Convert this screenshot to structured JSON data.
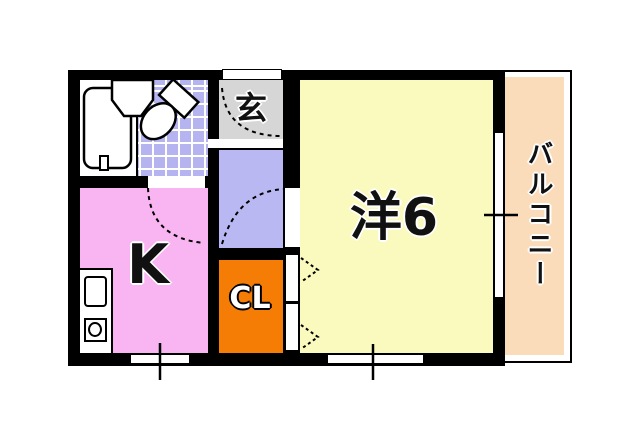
{
  "floorplan": {
    "title": "1K apartment floor plan",
    "rooms": {
      "genkan": {
        "label": "玄"
      },
      "kitchen": {
        "label": "K"
      },
      "closet": {
        "label": "CL"
      },
      "western_room": {
        "label": "洋6"
      },
      "balcony": {
        "label": "バルコニー"
      }
    },
    "colors": {
      "wall": "#000000",
      "background": "#ffffff",
      "tile": "#b5b4f0",
      "hallway": "#b9b8f2",
      "genkan": "#d6d6d6",
      "kitchen": "#f9b5f2",
      "closet": "#f57d05",
      "western_room": "#fafabe",
      "balcony": "#fbdcba"
    },
    "fixtures": [
      "bathtub",
      "washbasin",
      "toilet",
      "kitchen-counter",
      "kitchen-sink",
      "gas-stove",
      "entrance-door",
      "door-swing-arcs",
      "closet-folding-doors",
      "windows",
      "dimension-ticks"
    ]
  }
}
